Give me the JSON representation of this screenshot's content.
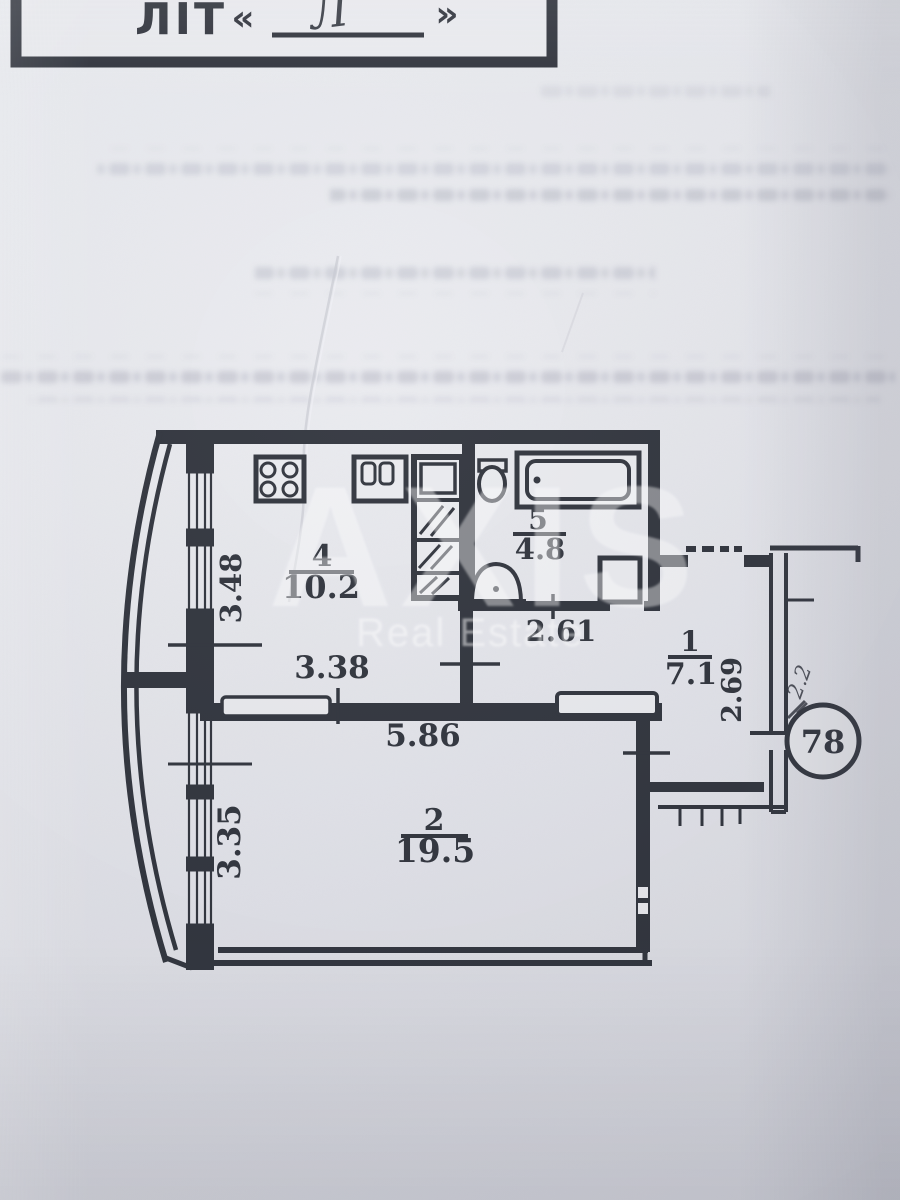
{
  "photo": {
    "header_box": {
      "label": "ЛІТ",
      "open_quote": "«",
      "handwritten_letter": "Л",
      "close_quote": "»"
    },
    "watermark": {
      "brand": "AXIS",
      "subtitle": "Real Estate"
    },
    "plan": {
      "apartment_circle_number": "78",
      "handwritten_note": "2.2",
      "rooms": [
        {
          "number": "4",
          "area": "10.2"
        },
        {
          "number": "5",
          "area": "4.8"
        },
        {
          "number": "1",
          "area": "7.1"
        },
        {
          "number": "2",
          "area": "19.5"
        }
      ],
      "dimensions": {
        "kitchen_wall": "3.48",
        "kitchen_width": "3.38",
        "bath_width": "2.61",
        "hall_wall": "2.69",
        "living_width": "5.86",
        "living_wall": "3.35"
      }
    }
  }
}
